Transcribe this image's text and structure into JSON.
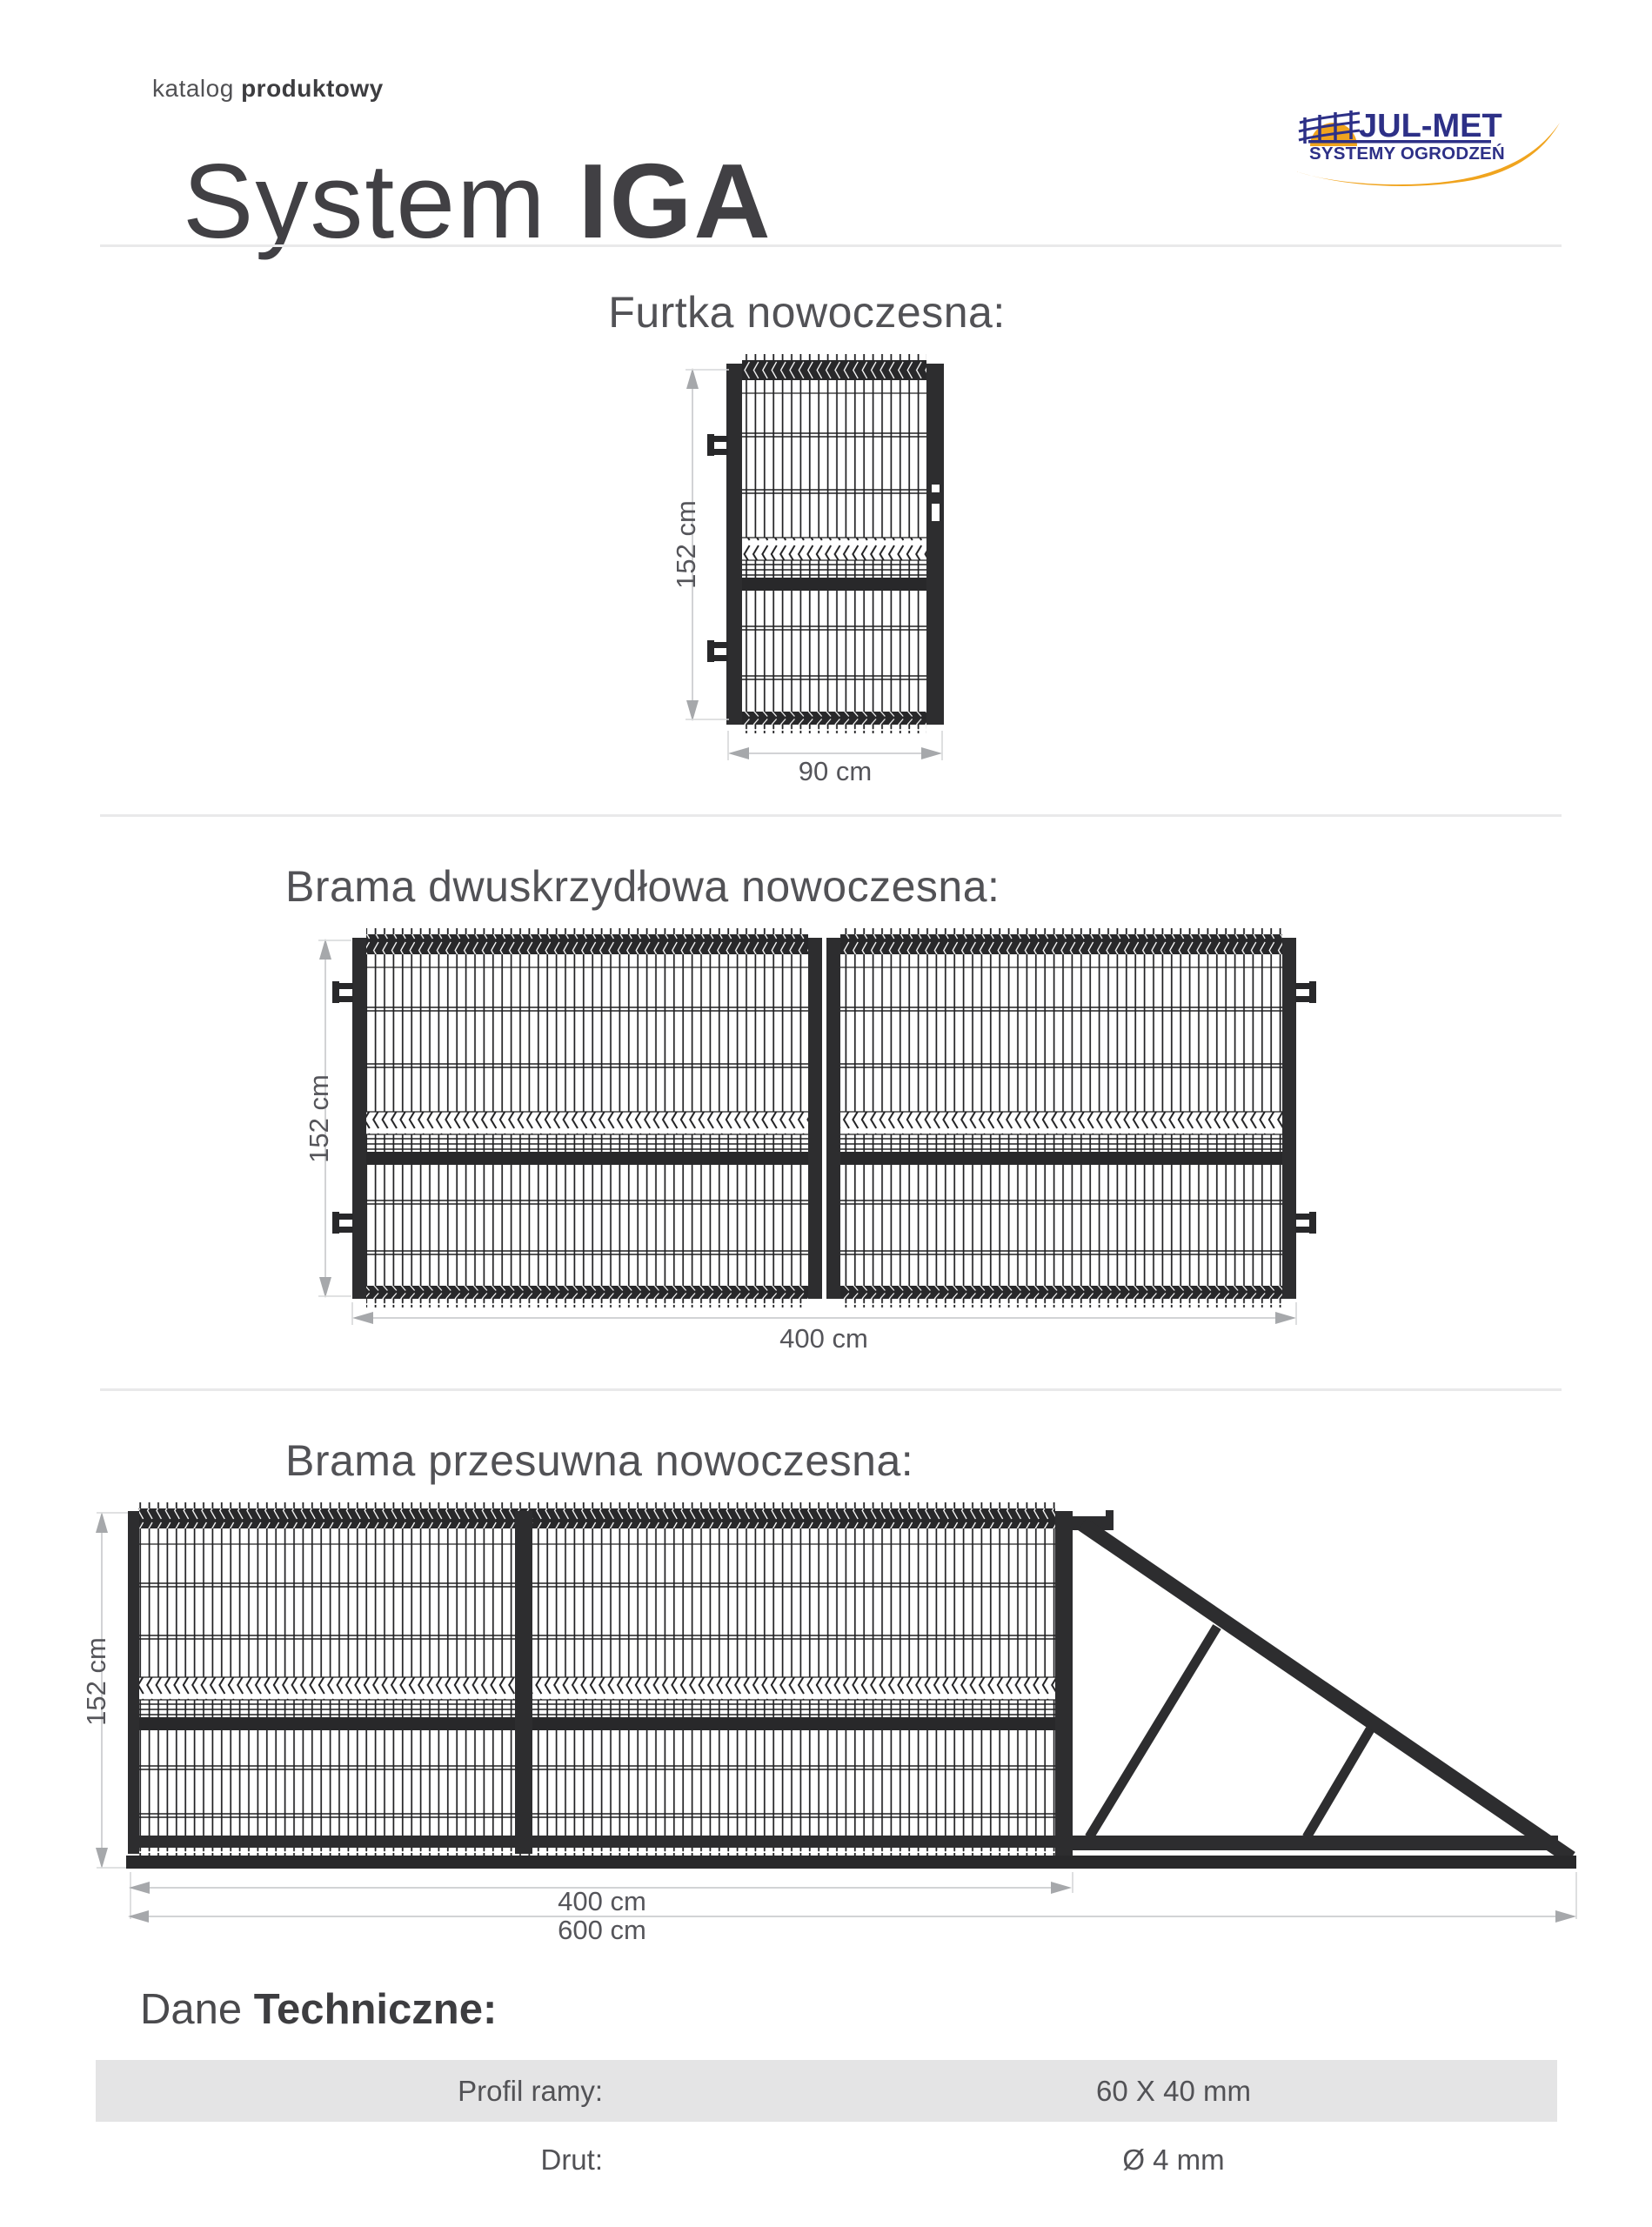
{
  "header": {
    "kicker_light": "katalog",
    "kicker_bold": "produktowy",
    "title_light": "System",
    "title_bold": "IGA"
  },
  "logo": {
    "name": "JUL-MET",
    "tagline": "SYSTEMY OGRODZEŃ",
    "navy": "#2D3087",
    "orange": "#F0A41E"
  },
  "sections": [
    {
      "id": "furtka",
      "title": "Furtka nowoczesna:",
      "dim_height": "152 cm",
      "dim_width": "90 cm"
    },
    {
      "id": "brama-dwuskrzydlowa",
      "title": "Brama dwuskrzydłowa nowoczesna:",
      "dim_height": "152 cm",
      "dim_width": "400 cm"
    },
    {
      "id": "brama-przesuwna",
      "title": "Brama przesuwna nowoczesna:",
      "dim_height": "152 cm",
      "dim_width_gate": "400 cm",
      "dim_width_total": "600 cm"
    }
  ],
  "tech": {
    "heading_light": "Dane",
    "heading_bold": "Techniczne:",
    "rows": [
      {
        "label": "Profil ramy:",
        "value": "60 X 40 mm"
      },
      {
        "label": "Drut:",
        "value": "Ø 4 mm"
      }
    ]
  }
}
